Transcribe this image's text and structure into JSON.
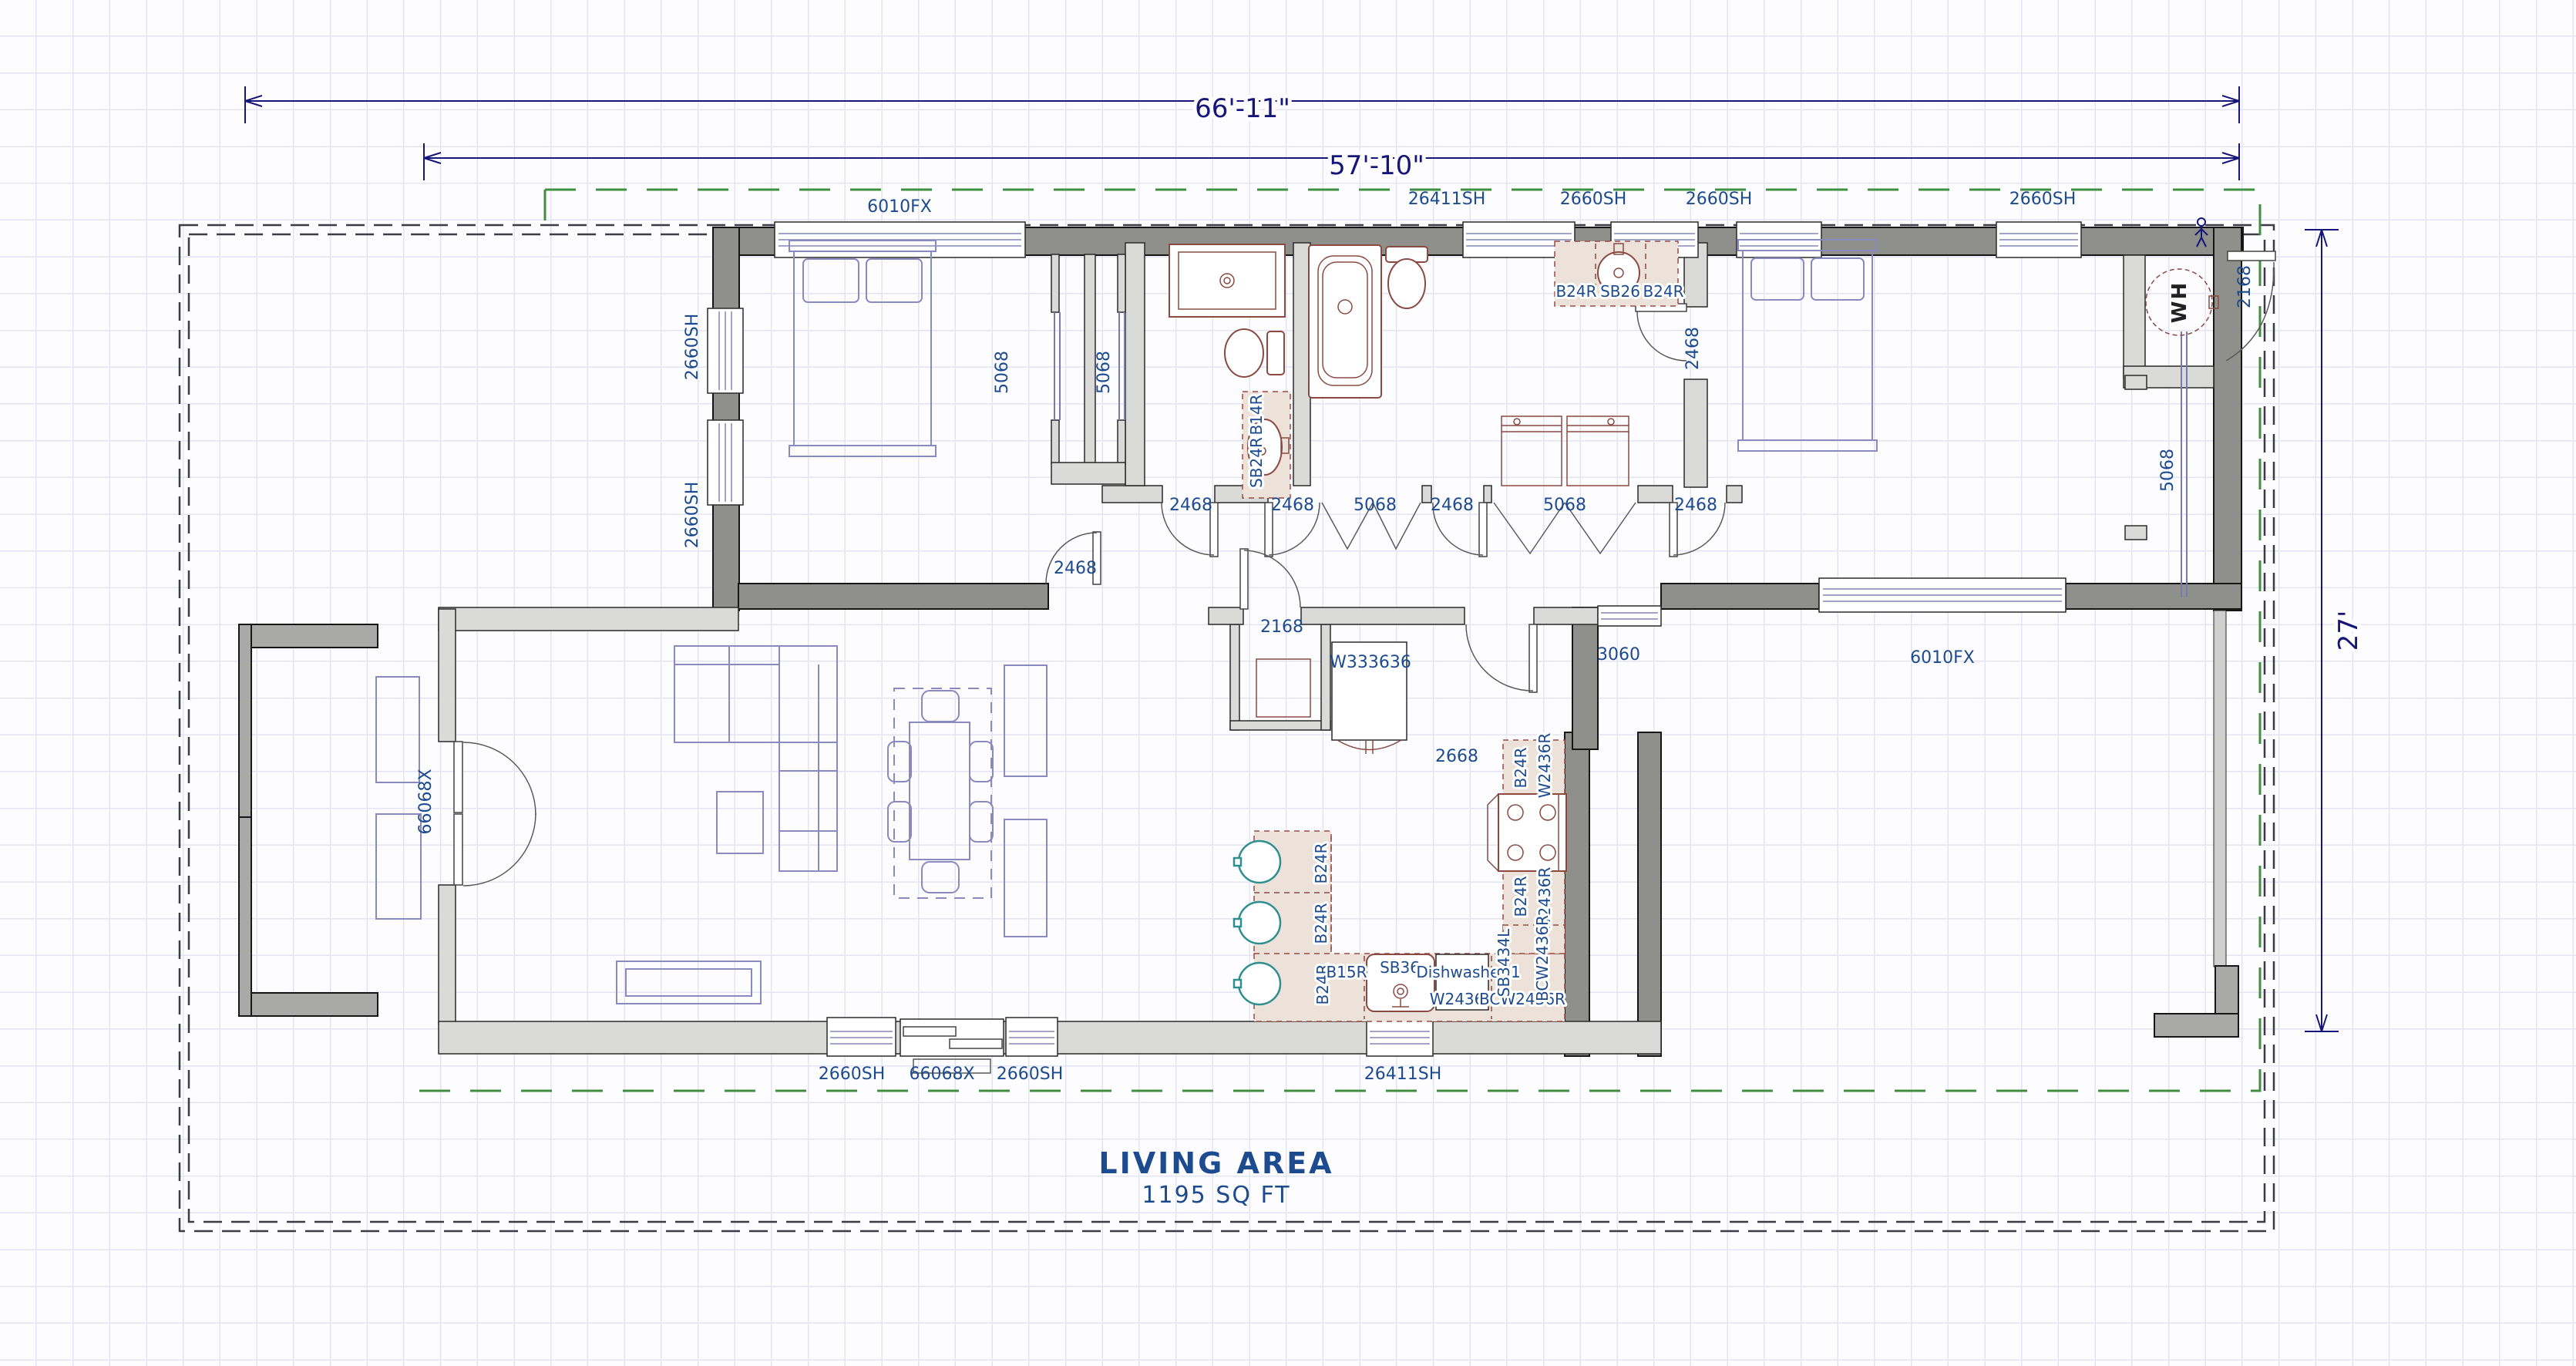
{
  "plan": {
    "area_title": "LIVING AREA",
    "area_value": "1195 SQ FT",
    "water_heater": "WH"
  },
  "dimensions": {
    "overall_width": "66'-11\"",
    "main_width": "57'-10\"",
    "depth": "27'"
  },
  "windows": {
    "top": [
      "6010FX",
      "26411SH",
      "2660SH",
      "2660SH",
      "2660SH"
    ],
    "left": [
      "2660SH",
      "2660SH"
    ],
    "bottom": [
      "2660SH",
      "66068X",
      "2660SH",
      "26411SH"
    ],
    "rear": [
      "3060",
      "6010FX"
    ]
  },
  "doors": {
    "entry": "66068X",
    "bedroom1": "2468",
    "bedroom1_closet": [
      "5068",
      "5068"
    ],
    "hall": [
      "2468",
      "2468",
      "5068",
      "2468",
      "5068",
      "2468"
    ],
    "pantry": "2168",
    "kitchen": "2668",
    "bath2": "2468",
    "bedroom2_closet": "5068",
    "water_heater_closet": "2168"
  },
  "cabinets": {
    "pantry_tall": "W333636",
    "bath1": [
      "B14R",
      "SB24R"
    ],
    "bath2_vanity": [
      "B24R",
      "SB26",
      "B24R"
    ],
    "peninsula": [
      "B24R",
      "B24R",
      "B24R"
    ],
    "base_row": [
      "B15R",
      "SB36",
      "Dishwasher 1",
      "W2436R",
      "BCW2436R"
    ],
    "right_run": [
      "B24R",
      "W2436R",
      "B24R",
      "W2436R",
      "SB3434L",
      "BCW2436R"
    ]
  }
}
